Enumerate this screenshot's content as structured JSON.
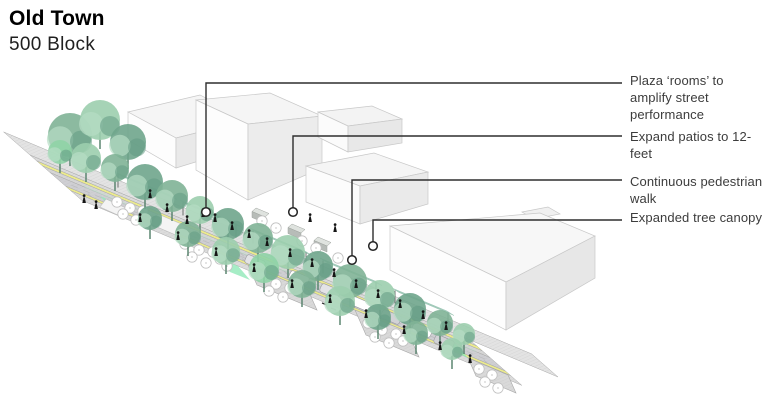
{
  "title": {
    "main": "Old Town",
    "sub": "500 Block"
  },
  "annotations": [
    {
      "label": "Plaza ‘rooms’ to\namplify street\nperformance",
      "line": {
        "x": 206,
        "y1": 212,
        "y2": 83
      }
    },
    {
      "label": "Expand patios to 12-\nfeet",
      "line": {
        "x": 293,
        "y1": 212,
        "y2": 136
      }
    },
    {
      "label": "Continuous pedestrian\nwalk",
      "line": {
        "x": 352,
        "y1": 260,
        "y2": 180
      }
    },
    {
      "label": "Expanded tree canopy",
      "line": {
        "x": 373,
        "y1": 246,
        "y2": 220
      }
    }
  ],
  "colors": {
    "background": "#ffffff",
    "title_text": "#000000",
    "annotation_text": "#3c3c3c",
    "leader_line": "#2e2e2e",
    "bike_lane_yellow": "#eceb8c",
    "roadway_gray": "#cfcfd3",
    "sidewalk_gray": "#dcdcdc",
    "plaza_gray": "#e3e3e3",
    "mint_green": "#90e8b8",
    "walk_green": "#bfe0cd",
    "canopy_teal": "#58a284",
    "building_white": "#fbfbfb",
    "tree_greens": [
      "#7fb396",
      "#9cceae",
      "#6fa58c",
      "#8fd3a6"
    ]
  },
  "scene": {
    "model": {
      "A": [
        30,
        155
      ],
      "u": [
        440,
        185
      ],
      "v": [
        48,
        42
      ]
    },
    "bands": [
      {
        "name": "plaza",
        "t": [
          0,
          1.2
        ],
        "s": [
          -0.55,
          0
        ],
        "fill": "#e3e3e3",
        "hatch": true
      },
      {
        "name": "far-sidewalk",
        "t": [
          0,
          1
        ],
        "s": [
          0,
          0.14
        ],
        "fill": "#dcdcdc",
        "hatch": true
      },
      {
        "name": "far-bike-lane",
        "t": [
          0,
          1
        ],
        "s": [
          0.14,
          0.26
        ],
        "fill": "#eceb8c",
        "hatch": false
      },
      {
        "name": "furnishing-zone",
        "t": [
          0,
          1
        ],
        "s": [
          0.26,
          0.42
        ],
        "fill": "#d6d6d6",
        "hatch": true
      },
      {
        "name": "roadway",
        "t": [
          0,
          1
        ],
        "s": [
          0.42,
          0.74
        ],
        "fill": "#cfcfd3",
        "hatch": true
      },
      {
        "name": "near-bike-lane",
        "t": [
          0,
          1
        ],
        "s": [
          0.74,
          0.85
        ],
        "fill": "#eceb8c",
        "hatch": false
      },
      {
        "name": "near-sidewalk",
        "t": [
          0,
          1
        ],
        "s": [
          0.85,
          1.08
        ],
        "fill": "#dcdcdc",
        "hatch": true
      }
    ],
    "walk_strip": {
      "t": [
        0.08,
        0.97
      ],
      "s": [
        0.36,
        0.43
      ],
      "fill": "#bfe0cd",
      "op": 0.55
    },
    "ticks": [
      {
        "t0": 0.28,
        "t1": 0.97,
        "step": 0.05,
        "s": [
          0.43,
          0.51
        ]
      },
      {
        "t0": 0.06,
        "t1": 0.97,
        "step": 0.05,
        "s": [
          0.655,
          0.735
        ]
      }
    ],
    "lane_line": {
      "t": [
        0.03,
        0.98
      ],
      "s": 0.585
    },
    "patches": [
      [
        100,
        196,
        116,
        203,
        126,
        214,
        110,
        207
      ],
      [
        218,
        258,
        238,
        266,
        250,
        280,
        230,
        272
      ],
      [
        438,
        336,
        456,
        344,
        468,
        358,
        450,
        350
      ]
    ],
    "buildings": [
      {
        "name": "building-northwest",
        "polys": [
          {
            "pts": [
              140,
              110,
              198,
              97,
              216,
              105,
              158,
              119
            ],
            "fill": "#f9f9f9"
          },
          {
            "pts": [
              128,
              112,
              200,
              95,
              248,
              120,
              176,
              138
            ],
            "fill": "#f5f5f5"
          },
          {
            "pts": [
              128,
              112,
              176,
              138,
              176,
              168,
              128,
              140
            ],
            "fill": "#fdfdfd"
          },
          {
            "pts": [
              176,
              138,
              248,
              120,
              248,
              146,
              176,
              168
            ],
            "fill": "#e9e9e9"
          }
        ]
      },
      {
        "name": "building-center",
        "polys": [
          {
            "pts": [
              196,
              100,
              270,
              93,
              322,
              116,
              248,
              124
            ],
            "fill": "#f5f5f5"
          },
          {
            "pts": [
              196,
              100,
              248,
              124,
              248,
              200,
              196,
              170
            ],
            "fill": "#fdfdfd"
          },
          {
            "pts": [
              248,
              124,
              322,
              116,
              322,
              168,
              248,
              200
            ],
            "fill": "#ececec"
          }
        ]
      },
      {
        "name": "building-center-annex",
        "polys": [
          {
            "pts": [
              318,
              112,
              372,
              106,
              402,
              119,
              348,
              126
            ],
            "fill": "#f3f3f3"
          },
          {
            "pts": [
              318,
              112,
              348,
              126,
              348,
              152,
              318,
              137
            ],
            "fill": "#fbfbfb"
          },
          {
            "pts": [
              348,
              126,
              402,
              119,
              402,
              143,
              348,
              152
            ],
            "fill": "#e8e8e8"
          }
        ]
      },
      {
        "name": "building-mid-east",
        "polys": [
          {
            "pts": [
              306,
              166,
              374,
              153,
              428,
              172,
              360,
              186
            ],
            "fill": "#f5f5f5"
          },
          {
            "pts": [
              306,
              166,
              360,
              186,
              360,
              224,
              306,
              202
            ],
            "fill": "#fcfcfc"
          },
          {
            "pts": [
              360,
              186,
              428,
              172,
              428,
              204,
              360,
              224
            ],
            "fill": "#eaeaea"
          }
        ]
      },
      {
        "name": "building-southeast-large",
        "polys": [
          {
            "pts": [
              522,
              212,
              548,
              207,
              560,
              214,
              534,
              219
            ],
            "fill": "#f0f0f0"
          },
          {
            "pts": [
              390,
              226,
              540,
              213,
              595,
              236,
              506,
              282
            ],
            "fill": "#f7f7f7"
          },
          {
            "pts": [
              390,
              226,
              506,
              282,
              506,
              330,
              390,
              270
            ],
            "fill": "#fdfdfd"
          },
          {
            "pts": [
              506,
              282,
              595,
              236,
              595,
              278,
              506,
              330
            ],
            "fill": "#e7e7e7"
          }
        ]
      }
    ],
    "platforms": [
      [
        158,
        214,
        186,
        226,
        178,
        236,
        150,
        224
      ],
      [
        106,
        199,
        126,
        208,
        120,
        216,
        100,
        207
      ]
    ],
    "decks": [
      [
        248,
        265,
        308,
        290,
        317,
        310,
        257,
        285
      ],
      [
        355,
        310,
        408,
        332,
        419,
        357,
        366,
        335
      ],
      [
        468,
        358,
        508,
        375,
        516,
        393,
        476,
        376
      ]
    ],
    "kiosks": [
      [
        256,
        208
      ],
      [
        292,
        224
      ],
      [
        318,
        237
      ]
    ],
    "pergolas": [
      [
        115,
        172
      ],
      [
        180,
        200
      ],
      [
        250,
        228
      ],
      [
        320,
        258
      ],
      [
        392,
        288
      ]
    ],
    "tables": [
      [
        117,
        202
      ],
      [
        130,
        208
      ],
      [
        123,
        214
      ],
      [
        136,
        220
      ],
      [
        143,
        211
      ],
      [
        262,
        221
      ],
      [
        276,
        228
      ],
      [
        302,
        241
      ],
      [
        316,
        248
      ],
      [
        338,
        258
      ],
      [
        185,
        244
      ],
      [
        199,
        250
      ],
      [
        192,
        257
      ],
      [
        206,
        263
      ],
      [
        213,
        252
      ],
      [
        220,
        259
      ],
      [
        227,
        266
      ],
      [
        262,
        277
      ],
      [
        276,
        284
      ],
      [
        269,
        291
      ],
      [
        283,
        297
      ],
      [
        290,
        288
      ],
      [
        368,
        323
      ],
      [
        382,
        330
      ],
      [
        375,
        337
      ],
      [
        389,
        343
      ],
      [
        396,
        334
      ],
      [
        403,
        341
      ],
      [
        479,
        369
      ],
      [
        492,
        375
      ],
      [
        485,
        382
      ],
      [
        498,
        388
      ]
    ],
    "cars": [
      [
        299,
        278,
        0
      ],
      [
        330,
        291,
        1
      ],
      [
        361,
        304,
        0
      ],
      [
        391,
        317,
        2
      ],
      [
        422,
        330,
        0
      ],
      [
        255,
        262,
        1
      ],
      [
        444,
        342,
        2
      ]
    ],
    "bikes": [
      [
        322,
        303,
        327,
        305
      ],
      [
        331,
        308,
        336,
        310
      ]
    ],
    "trees": [
      [
        70,
        135,
        22,
        0
      ],
      [
        100,
        120,
        20,
        1
      ],
      [
        128,
        142,
        18,
        2
      ],
      [
        86,
        158,
        15,
        1
      ],
      [
        115,
        168,
        14,
        0
      ],
      [
        145,
        182,
        18,
        2
      ],
      [
        60,
        152,
        12,
        3
      ],
      [
        172,
        196,
        16,
        0
      ],
      [
        200,
        210,
        14,
        1
      ],
      [
        228,
        224,
        16,
        2
      ],
      [
        258,
        238,
        15,
        0
      ],
      [
        288,
        252,
        17,
        1
      ],
      [
        318,
        266,
        15,
        2
      ],
      [
        350,
        281,
        17,
        0
      ],
      [
        380,
        295,
        15,
        1
      ],
      [
        410,
        309,
        16,
        2
      ],
      [
        440,
        323,
        13,
        0
      ],
      [
        464,
        334,
        11,
        1
      ],
      [
        150,
        218,
        12,
        2
      ],
      [
        188,
        234,
        13,
        0
      ],
      [
        226,
        251,
        14,
        1
      ],
      [
        264,
        268,
        15,
        3
      ],
      [
        302,
        284,
        14,
        0
      ],
      [
        340,
        301,
        15,
        1
      ],
      [
        378,
        317,
        13,
        2
      ],
      [
        416,
        333,
        12,
        0
      ],
      [
        452,
        349,
        11,
        1
      ]
    ],
    "people": [
      [
        84,
        203
      ],
      [
        96,
        209
      ],
      [
        150,
        198
      ],
      [
        167,
        212
      ],
      [
        187,
        224
      ],
      [
        203,
        217
      ],
      [
        215,
        222
      ],
      [
        232,
        230
      ],
      [
        249,
        238
      ],
      [
        267,
        246
      ],
      [
        290,
        257
      ],
      [
        312,
        267
      ],
      [
        334,
        277
      ],
      [
        356,
        288
      ],
      [
        378,
        298
      ],
      [
        400,
        308
      ],
      [
        423,
        319
      ],
      [
        446,
        330
      ],
      [
        140,
        222
      ],
      [
        178,
        240
      ],
      [
        216,
        256
      ],
      [
        254,
        272
      ],
      [
        292,
        288
      ],
      [
        330,
        303
      ],
      [
        366,
        318
      ],
      [
        404,
        334
      ],
      [
        440,
        350
      ],
      [
        470,
        363
      ],
      [
        310,
        222
      ],
      [
        335,
        232
      ]
    ]
  }
}
